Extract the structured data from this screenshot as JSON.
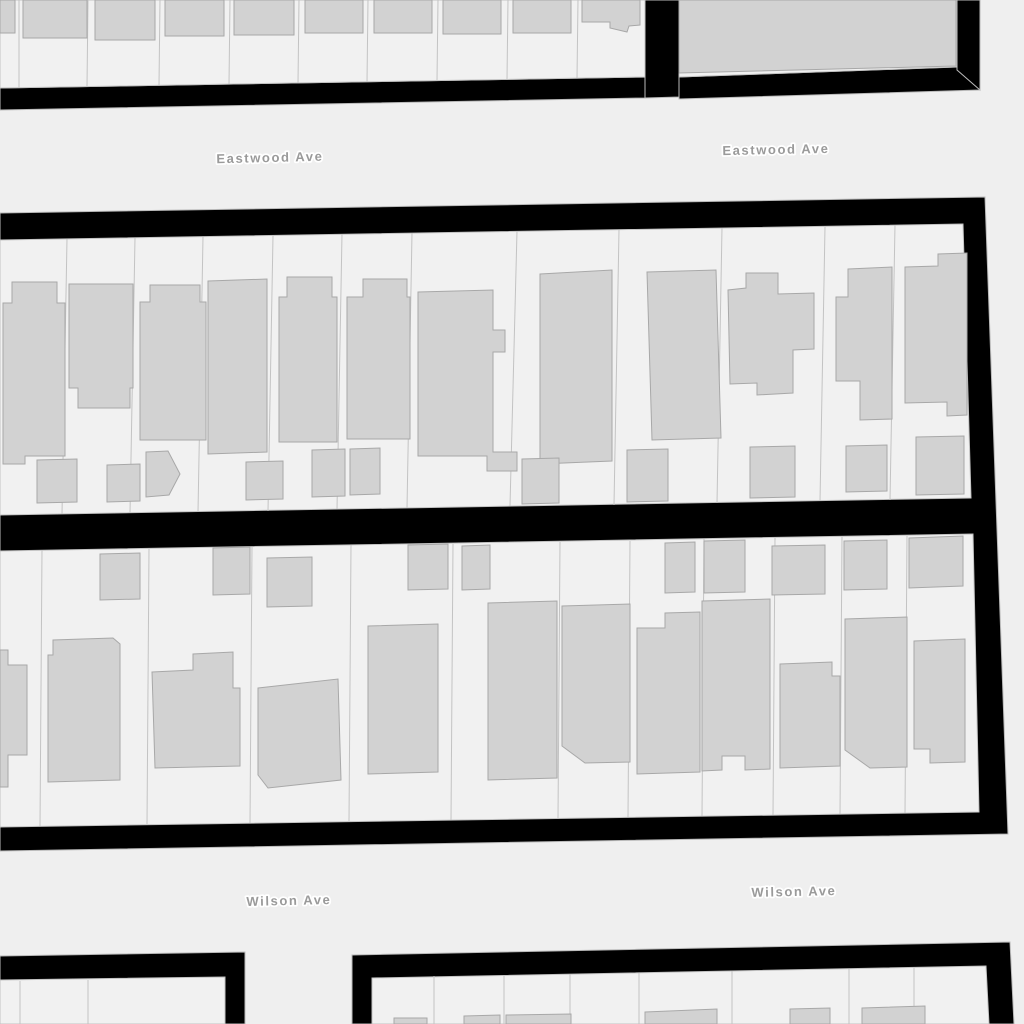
{
  "map": {
    "type": "parcel-basemap",
    "streets": {
      "labels": [
        {
          "text": "Eastwood Ave",
          "x": 270,
          "y": 162,
          "rotation": -1.4
        },
        {
          "text": "Eastwood Ave",
          "x": 776,
          "y": 154,
          "rotation": -1.2
        },
        {
          "text": "Wilson Ave",
          "x": 289,
          "y": 905,
          "rotation": -1.3
        },
        {
          "text": "Wilson Ave",
          "x": 794,
          "y": 896,
          "rotation": -1.2
        }
      ]
    },
    "colors": {
      "street": "#efefef",
      "parcel": "#f1f1f1",
      "parcel_line": "#c3c3c3",
      "building_fill": "#d2d2d2",
      "building_stroke": "#a8a8a8",
      "block_border": "#000000",
      "block_edge_line": "#bababa",
      "label_text": "#9a9a9a",
      "label_halo": "#ffffff"
    },
    "geometry": {
      "block_borders": [
        "0,88 645,77 645,98 0,110",
        "645,0 679,0 679,97 645,98",
        "679,77 980,66 980,90 679,99",
        "957,0 980,0 980,90 957,70",
        "0,213 985,197 1008,834 0,851",
        "0,956 245,952 245,1024 0,1024",
        "352,955 1010,942 1014,1024 352,1024"
      ],
      "parcel_areas": [
        "0,0 645,0 645,77 0,88",
        "679,0 957,0 957,67 679,77",
        "0,240 963,224 971,498 0,515",
        "0,551 973,534 979,812 0,827",
        "0,980 225,977 225,1024 0,1024",
        "372,978 986,966 989,1024 372,1024"
      ],
      "parcel_lines": [
        "19,0 19,88",
        "88,0 87,86",
        "160,0 159,85",
        "230,0 229,84",
        "299,0 298,83",
        "368,0 367,82",
        "438,0 437,80",
        "508,0 507,79",
        "578,0 577,78",
        "67,239 62,514",
        "135,238 130,513",
        "203,237 198,512",
        "273,236 268,511",
        "342,234 337,509",
        "412,233 407,508",
        "517,231 510,506",
        "619,230 614,505",
        "722,228 717,503",
        "825,227 820,501",
        "895,225 890,500",
        "42,550 40,826",
        "149,549 147,824",
        "252,547 250,823",
        "351,545 349,821",
        "453,544 451,820",
        "560,542 558,818",
        "630,541 628,817",
        "704,539 702,816",
        "775,538 773,815",
        "842,537 840,814",
        "907,536 905,813",
        "20,981 20,1024",
        "88,980 88,1024",
        "434,976 434,1024",
        "504,975 504,1024",
        "570,974 570,1024",
        "639,973 639,1024",
        "732,971 732,1024",
        "849,969 849,1024",
        "914,968 914,1024"
      ],
      "buildings": [
        "0,0 15,0 15,33 0,33",
        "23,0 87,0 87,38 23,38",
        "95,0 155,0 155,40 95,40",
        "165,0 224,0 224,36 165,36",
        "234,0 294,0 294,35 234,35",
        "305,0 363,0 363,33 305,33",
        "374,0 432,0 432,33 374,33",
        "443,0 501,0 501,34 443,34",
        "513,0 571,0 571,33 513,33",
        "582,0 640,0 640,25 629,26 627,32 610,28 610,22 582,22",
        "679,0 956,0 956,66 679,73",
        "3,303 12,303 12,282 57,282 57,303 65,303 65,456 25,456 25,464 3,464",
        "69,284 133,284 133,388 130,388 130,408 78,408 78,388 69,388",
        "140,302 150,302 150,285 200,285 200,302 206,302 206,440 140,440",
        "208,281 267,279 267,452 208,454",
        "279,297 287,297 287,277 332,277 332,297 337,297 337,442 279,442",
        "347,297 363,297 363,279 407,279 407,297 410,297 410,439 347,439",
        "418,292 493,290 493,330 505,330 505,352 493,352 493,452 517,452 517,471 487,471 487,456 418,456",
        "540,274 612,270 612,461 540,464",
        "647,272 716,270 721,438 652,440",
        "746,273 778,273 778,294 814,293 814,349 793,350 793,393 757,395 757,383 730,384 728,290 746,288",
        "848,269 892,267 892,419 860,420 860,381 836,381 836,297 848,297",
        "905,267 938,266 938,254 967,253 967,415 947,416 947,402 905,403",
        "37,460 77,459 77,502 37,503",
        "107,465 140,464 140,501 107,502",
        "146,452 168,451 180,474 169,495 146,497",
        "246,462 283,461 283,499 246,500",
        "312,450 345,449 345,496 312,497",
        "350,449 380,448 380,494 350,495",
        "522,459 559,458 559,503 522,504",
        "627,450 668,449 668,501 627,502",
        "750,447 795,446 795,497 750,498",
        "846,446 887,445 887,491 846,492",
        "916,437 964,436 964,494 916,495",
        "100,554 140,553 140,599 100,600",
        "213,548 250,547 250,594 213,595",
        "267,558 312,557 312,606 267,607",
        "408,545 448,544 448,589 408,590",
        "462,546 490,545 490,589 462,590",
        "665,543 695,542 695,592 665,593",
        "704,541 745,540 745,592 704,593",
        "772,546 825,545 825,594 772,595",
        "844,541 887,540 887,589 844,590",
        "909,538 963,536 963,586 909,588",
        "0,650 8,650 8,665 27,665 27,755 8,755 8,787 0,787",
        "48,655 53,655 53,640 113,638 120,644 120,780 48,782",
        "152,672 193,670 193,654 233,652 233,688 240,688 240,766 155,768",
        "258,688 338,679 341,780 268,788 258,775",
        "368,626 438,624 438,772 368,774",
        "488,603 557,601 557,778 488,780",
        "562,606 630,604 630,762 585,763 562,746",
        "637,628 665,628 665,613 700,612 700,772 637,774",
        "702,601 770,599 770,769 745,770 745,756 722,756 722,770 702,771",
        "780,664 832,662 832,676 840,676 840,766 780,768",
        "845,619 907,617 907,767 870,768 845,750",
        "914,641 965,639 965,762 930,763 930,749 914,749",
        "394,1018 427,1018 427,1024 394,1024",
        "464,1016 500,1015 500,1024 464,1024",
        "506,1015 571,1014 571,1024 506,1024",
        "645,1012 717,1009 717,1024 645,1024",
        "790,1009 830,1008 830,1024 790,1024",
        "862,1008 925,1006 925,1024 862,1024"
      ]
    }
  }
}
